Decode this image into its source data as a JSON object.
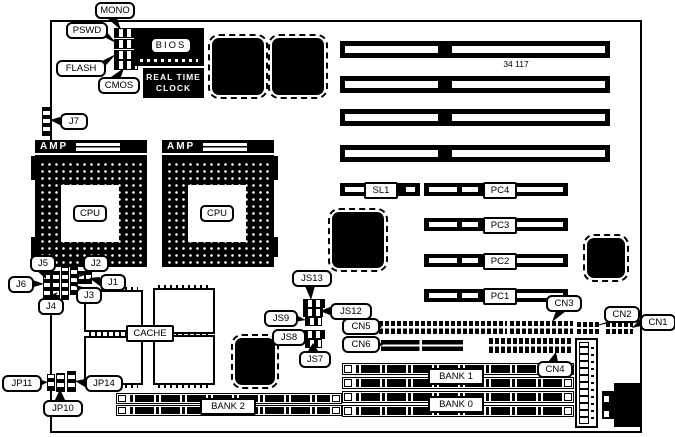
{
  "board": {
    "part_number": "34 117",
    "colors": {
      "ink": "#000000",
      "paper": "#ffffff"
    }
  },
  "labels": {
    "mono": "MONO",
    "pswd": "PSWD",
    "flash": "FLASH",
    "cmos": "CMOS",
    "bios": "BIOS",
    "rtc_line1": "REAL TIME",
    "rtc_line2": "CLOCK",
    "j7": "J7",
    "amp": "AMP",
    "cpu": "CPU",
    "j5": "J5",
    "j2": "J2",
    "j6": "J6",
    "j1": "J1",
    "j4": "J4",
    "j3": "J3",
    "cache": "CACHE",
    "jp14": "JP14",
    "jp11": "JP11",
    "jp10": "JP10",
    "js13": "JS13",
    "js12": "JS12",
    "js9": "JS9",
    "js8": "JS8",
    "js7": "JS7",
    "sl1": "SL1",
    "pc4": "PC4",
    "pc3": "PC3",
    "pc2": "PC2",
    "pc1": "PC1",
    "cn1": "CN1",
    "cn2": "CN2",
    "cn3": "CN3",
    "cn4": "CN4",
    "cn5": "CN5",
    "cn6": "CN6",
    "bank0": "BANK 0",
    "bank1": "BANK 1",
    "bank2": "BANK 2"
  }
}
